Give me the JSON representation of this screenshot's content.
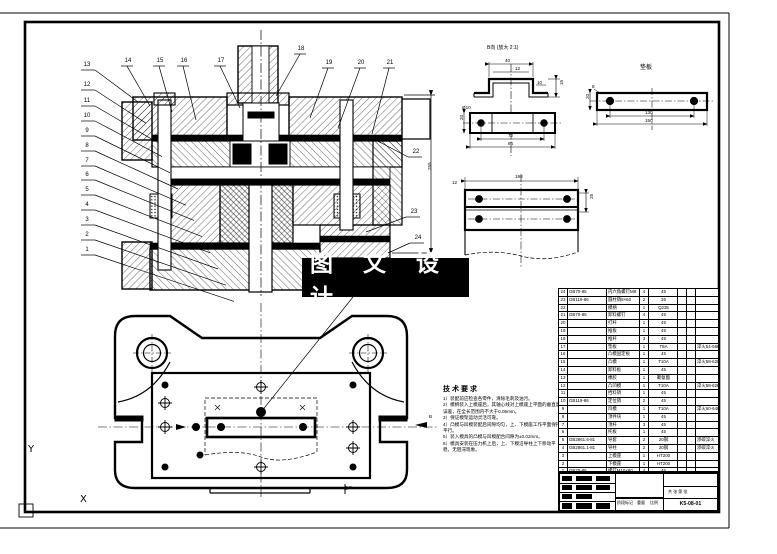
{
  "page": {
    "background": "#ffffff",
    "line_color": "#000000"
  },
  "banner": {
    "text": "图 文 设 计",
    "bg": "#000000",
    "fg": "#ffffff"
  },
  "ucs": {
    "y_label": "Y",
    "x_label": "X"
  },
  "callouts": {
    "left": [
      "13",
      "12",
      "11",
      "10",
      "9",
      "8",
      "7",
      "6",
      "5",
      "4",
      "3",
      "2",
      "1"
    ],
    "top": [
      "14",
      "15",
      "16",
      "17",
      "18",
      "19",
      "20",
      "21"
    ],
    "right": [
      "22",
      "23",
      "24"
    ]
  },
  "details": {
    "view_b_label": "B向 (放大 2:1)",
    "backing_plate_label": "垫板"
  },
  "dims": [
    "40",
    "12",
    "15",
    "10",
    "Ø10",
    "72",
    "86",
    "20",
    "8",
    "130",
    "150",
    "20",
    "198",
    "25",
    "12",
    "255",
    "B",
    "B"
  ],
  "tech_notes": {
    "title": "技术要求",
    "items": [
      "1）装配前应检查各零件，清除毛刺及油污。",
      "2）模柄装入上模座后，其轴心线对上模座上平面的垂直度误差，在全长范围内不大于0.05mm。",
      "3）保证模架运动灵活可靠。",
      "4）凸模与凹模装配后间隙均匀，上、下模座工作平面保持平行。",
      "5）装入模具的凸模与凹模配合间隙为±0.02mm。",
      "6）模具安装在压力机上后，上、下模沿导柱上下移动平稳，无阻滞现象。"
    ]
  },
  "bom": {
    "headers": [
      "序号",
      "代号",
      "名称",
      "数量",
      "材料",
      "单件",
      "总计",
      "备注"
    ],
    "rows": [
      [
        "24",
        "GB70-85",
        "内六角螺钉M8",
        "4",
        "45",
        "",
        "",
        ""
      ],
      [
        "23",
        "GB119-86",
        "圆柱销8×60",
        "2",
        "35",
        "",
        "",
        ""
      ],
      [
        "22",
        "",
        "模柄",
        "1",
        "Q235",
        "",
        "",
        ""
      ],
      [
        "21",
        "GB70-85",
        "卸料螺钉",
        "4",
        "45",
        "",
        "",
        ""
      ],
      [
        "20",
        "",
        "打杆",
        "1",
        "45",
        "",
        "",
        ""
      ],
      [
        "19",
        "",
        "推板",
        "1",
        "45",
        "",
        "",
        ""
      ],
      [
        "18",
        "",
        "推杆",
        "3",
        "45",
        "",
        "",
        ""
      ],
      [
        "17",
        "",
        "垫板",
        "1",
        "T8A",
        "",
        "",
        "淬火54-58HRC"
      ],
      [
        "16",
        "",
        "凸模固定板",
        "1",
        "45",
        "",
        "",
        ""
      ],
      [
        "15",
        "",
        "凸模",
        "1",
        "T10A",
        "",
        "",
        "淬火58-62HRC"
      ],
      [
        "14",
        "",
        "卸料板",
        "1",
        "45",
        "",
        "",
        ""
      ],
      [
        "13",
        "",
        "橡胶",
        "1",
        "聚氨酯",
        "",
        "",
        ""
      ],
      [
        "12",
        "",
        "凸凹模",
        "1",
        "T10A",
        "",
        "",
        "淬火58-62HRC"
      ],
      [
        "11",
        "",
        "挡料销",
        "1",
        "45",
        "",
        "",
        ""
      ],
      [
        "10",
        "GB119-86",
        "定位销",
        "2",
        "45",
        "",
        "",
        ""
      ],
      [
        "9",
        "",
        "凹模",
        "1",
        "T10A",
        "",
        "",
        "淬火60-64HRC"
      ],
      [
        "8",
        "",
        "顶件块",
        "1",
        "45",
        "",
        "",
        ""
      ],
      [
        "7",
        "",
        "顶杆",
        "3",
        "45",
        "",
        "",
        ""
      ],
      [
        "6",
        "",
        "托板",
        "1",
        "45",
        "",
        "",
        ""
      ],
      [
        "5",
        "GB2861.6-81",
        "导套",
        "2",
        "20钢",
        "",
        "",
        "渗碳淬火"
      ],
      [
        "4",
        "GB2861.1-81",
        "导柱",
        "2",
        "20钢",
        "",
        "",
        "渗碳淬火"
      ],
      [
        "3",
        "",
        "上模座",
        "1",
        "HT200",
        "",
        "",
        ""
      ],
      [
        "2",
        "",
        "下模座",
        "1",
        "HT200",
        "",
        "",
        ""
      ],
      [
        "1",
        "GB70-85",
        "螺钉M10×90",
        "4",
        "45",
        "",
        "",
        ""
      ]
    ]
  },
  "title_block": {
    "stage": "阶段标记",
    "weight": "重量",
    "scale": "比例",
    "sheets": "共 张 第 张",
    "drawing_no": "K5-08-01"
  }
}
